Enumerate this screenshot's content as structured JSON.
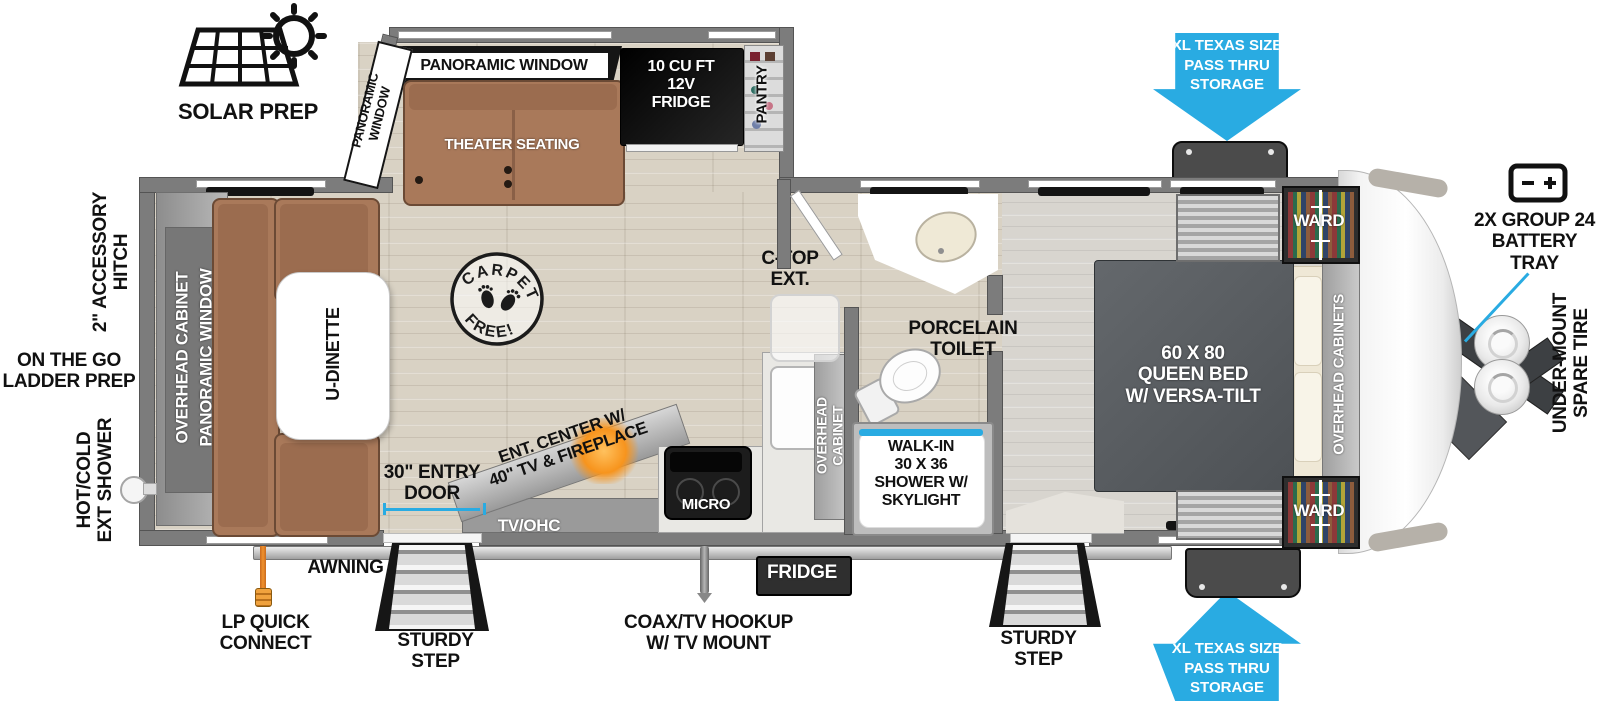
{
  "title": "Travel trailer floorplan",
  "colors": {
    "arrow_blue": "#29abe2",
    "wall_grey": "#7c7c7c",
    "sofa_brown": "#a9795a",
    "bed_grey": "#5b5f63",
    "fire_orange": "#f7941d"
  },
  "badges": {
    "solar_prep": "SOLAR PREP",
    "pass_thru_top": "XL TEXAS SIZE\nPASS THRU\nSTORAGE",
    "pass_thru_bottom": "XL TEXAS SIZE\nPASS THRU\nSTORAGE"
  },
  "exterior": {
    "battery_tray": "2X GROUP 24\nBATTERY\nTRAY",
    "under_mount_spare_tire": "UNDER-MOUNT\nSPARE TIRE",
    "accessory_hitch": "2\" ACCESSORY\nHITCH",
    "ladder_prep": "ON THE GO\nLADDER PREP",
    "ext_shower": "HOT/COLD\nEXT SHOWER",
    "lp_quick_connect": "LP QUICK\nCONNECT",
    "awning": "AWNING",
    "sturdy_step_left": "STURDY\nSTEP",
    "coax_tv_hookup": "COAX/TV HOOKUP\nW/ TV MOUNT",
    "exterior_fridge": "FRIDGE",
    "sturdy_step_right": "STURDY\nSTEP",
    "entry_door": "30\" ENTRY\nDOOR"
  },
  "interior": {
    "panoramic_window_top": "PANORAMIC WINDOW",
    "panoramic_window_side": "PANORAMIC\nWINDOW",
    "theater_seating": "THEATER SEATING",
    "fridge_12v": "10 CU FT\n12V\nFRIDGE",
    "pantry": "PANTRY",
    "rear_overhead_cabinet": "OVERHEAD CABINET",
    "rear_panoramic_window": "PANORAMIC WINDOW",
    "u_dinette": "U-DINETTE",
    "carpet_free_top": "CARPET",
    "carpet_free_bottom": "FREE!",
    "ctop_ext": "C-TOP\nEXT.",
    "kitchen_overhead_cabinet": "OVERHEAD\nCABINET",
    "micro": "MICRO",
    "tv_ohc": "TV/OHC",
    "ent_center": "ENT. CENTER W/\n40\" TV & FIREPLACE",
    "porcelain_toilet": "PORCELAIN\nTOILET",
    "walk_in_shower": "WALK-IN\n30 X 36\nSHOWER W/\nSKYLIGHT",
    "queen_bed": "60 X 80\nQUEEN BED\nW/ VERSA-TILT",
    "ward_top": "WARD",
    "ward_bottom": "WARD",
    "bed_overhead_cabinets": "OVERHEAD CABINETS"
  }
}
